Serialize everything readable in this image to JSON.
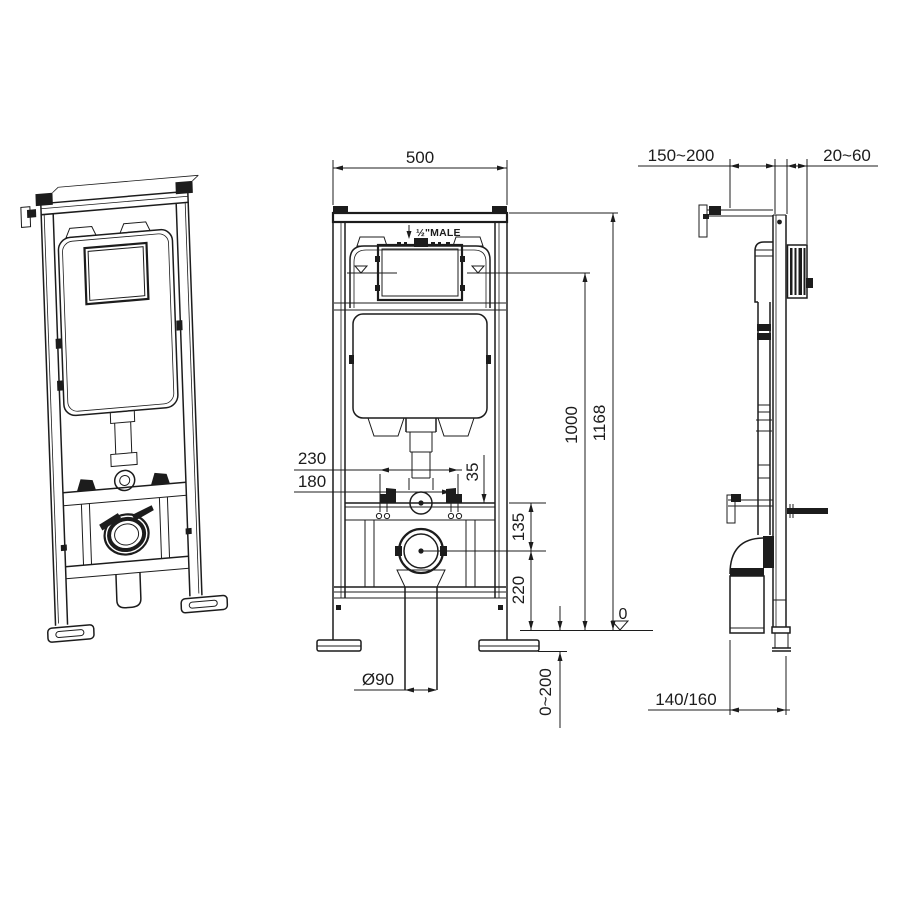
{
  "labels": {
    "front_width": "500",
    "inlet": "½\"MALE",
    "bolt_spacing_outer": "230",
    "bolt_spacing_inner": "180",
    "offset_small": "35",
    "flush_bend_height": "135",
    "drain_height": "220",
    "cistern_water_height": "1000",
    "frame_height": "1168",
    "datum_zero": "0",
    "foot_adjust_range": "0~200",
    "outlet_diameter": "Ø90",
    "wall_offset_range": "150~200",
    "plate_depth_range": "20~60",
    "drain_offset": "140/160"
  },
  "colors": {
    "line": "#1c1c1c",
    "background": "#ffffff"
  }
}
